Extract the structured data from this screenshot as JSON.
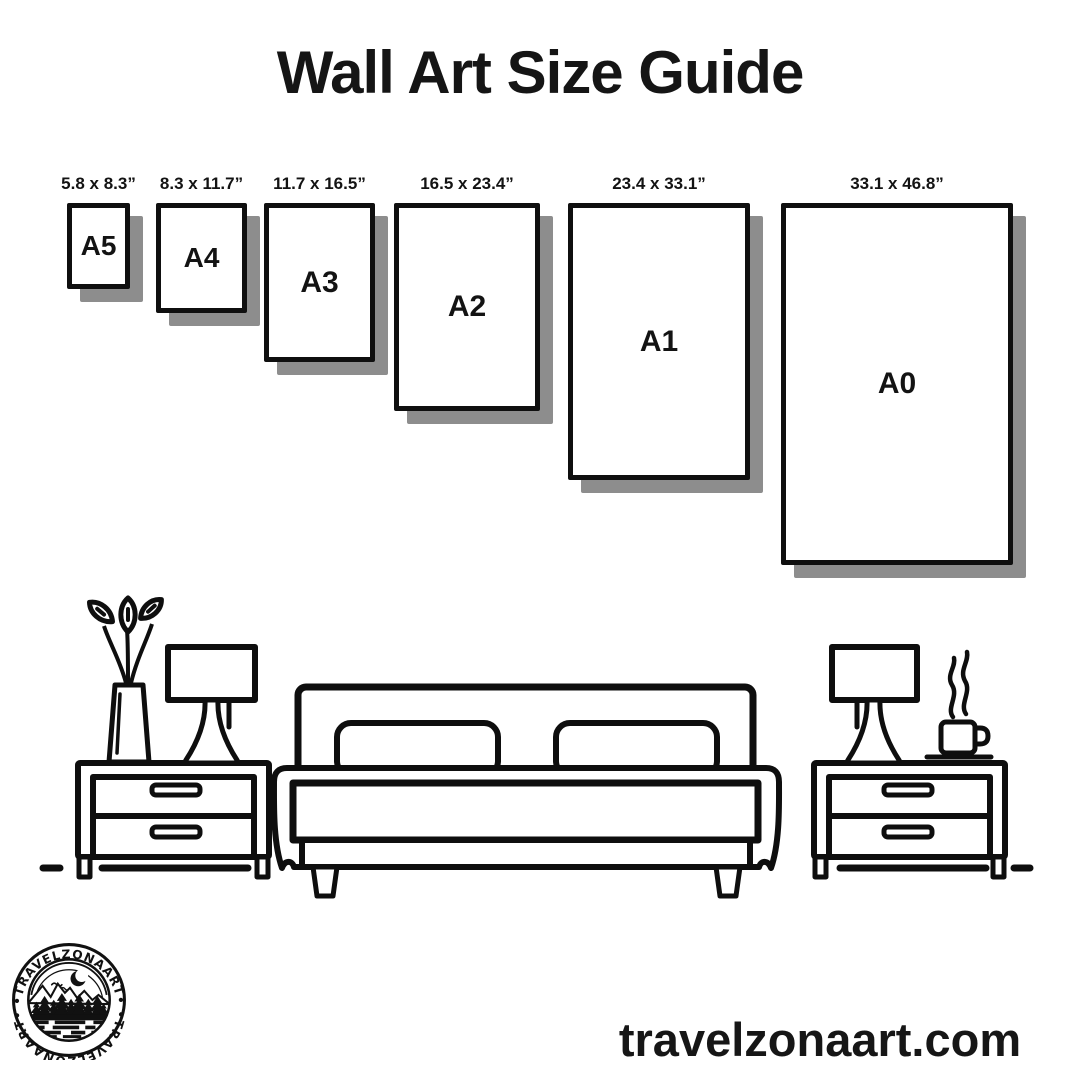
{
  "title": "Wall Art Size Guide",
  "size_guide": {
    "frames": [
      {
        "label": "A5",
        "dimensions": "5.8 x 8.3”"
      },
      {
        "label": "A4",
        "dimensions": "8.3 x 11.7”"
      },
      {
        "label": "A3",
        "dimensions": "11.7 x 16.5”"
      },
      {
        "label": "A2",
        "dimensions": "16.5 x 23.4”"
      },
      {
        "label": "A1",
        "dimensions": "23.4 x 33.1”"
      },
      {
        "label": "A0",
        "dimensions": "33.1 x 46.8”"
      }
    ]
  },
  "footer": {
    "website": "travelzonaart.com",
    "logo": {
      "arc_text_top": "•TRAVELZONAART•",
      "arc_text_bottom": "•TRAVELZONAART•"
    }
  },
  "colors": {
    "ink": "#111111",
    "frame_shadow": "#8d8d8d",
    "background": "#ffffff"
  }
}
